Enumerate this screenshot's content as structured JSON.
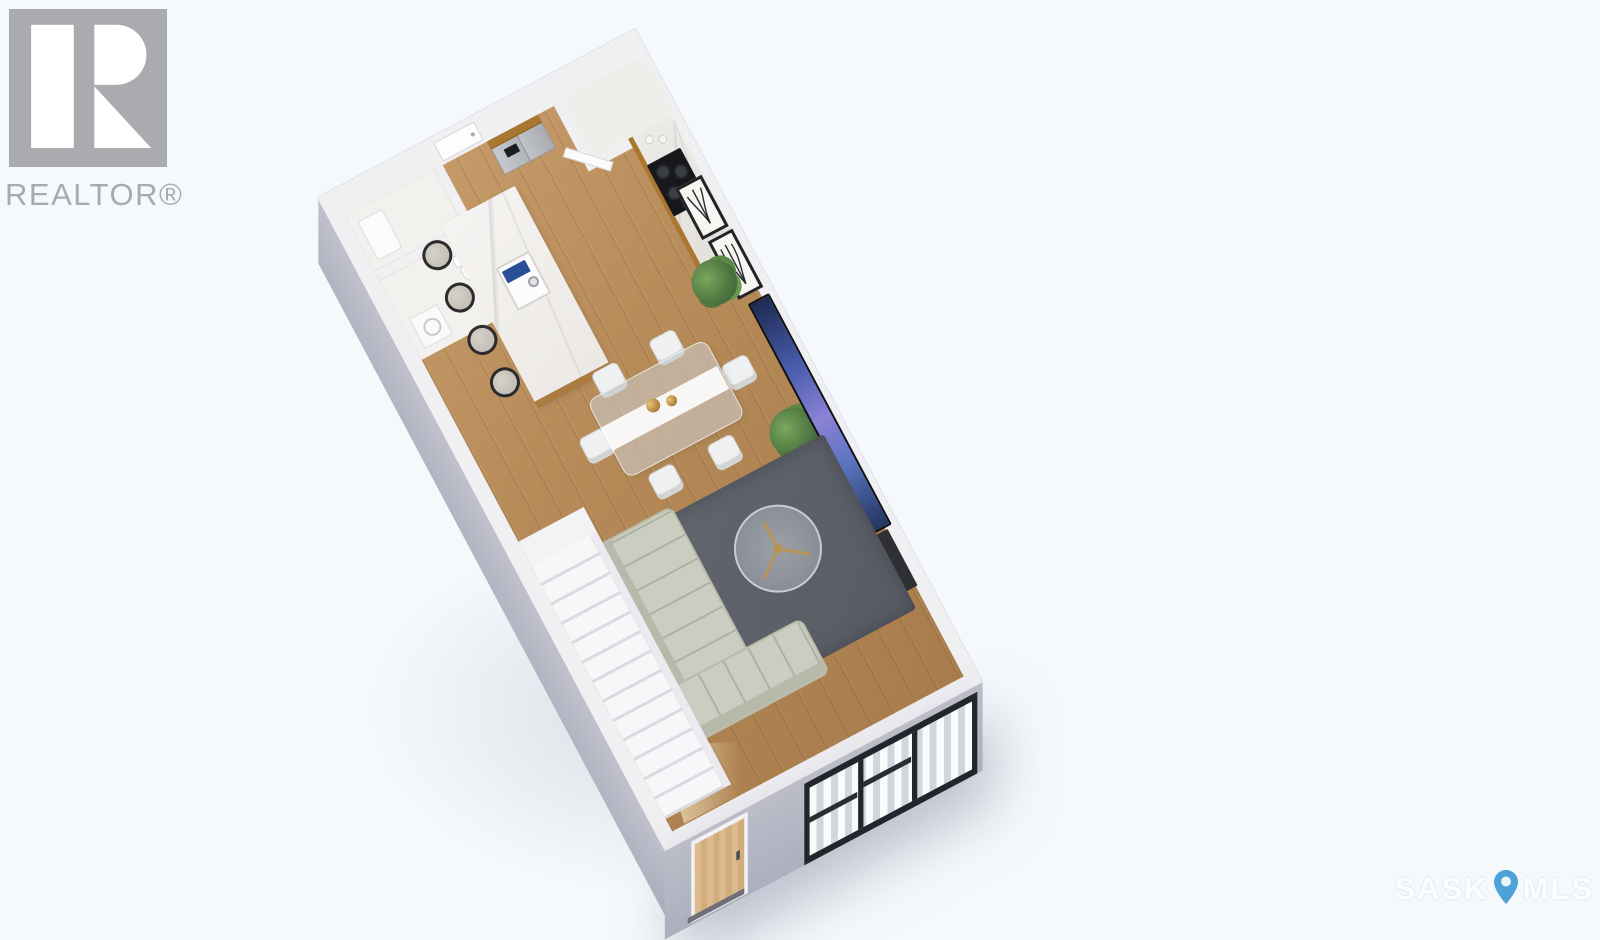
{
  "branding": {
    "realtor_label": "REALTOR®",
    "logo_color": "#a9abae",
    "logo_icon": "realtor-block-r-logo"
  },
  "watermark": {
    "sask": "SASK",
    "mls": "MLS",
    "pin_icon": "map-pin-icon",
    "pin_color": "#4da3d8",
    "text_color": "#ffffff"
  },
  "palette": {
    "page_background": "#f6f9fc",
    "interior_walls": "#f0eff2",
    "exterior_walls": "#b6b7c4",
    "wood_floor": "#b98c5c",
    "marble_counters": "#f3f1ee",
    "cabinet_wood": "#a9772f",
    "area_rug": "#5e6168",
    "sofa": "#cacdbf",
    "cooktop": "#17181b",
    "island_sink_accent": "#2b4f97",
    "tv_screen": "#4a5dae",
    "plants": "#5c8a46",
    "window_frames": "#22252a",
    "front_door_wood": "#d8b483",
    "stairs": "#f4f3f6"
  },
  "floorplan": {
    "view": "isometric 3D render, single level, rotated",
    "features": [
      {
        "name": "entry-door",
        "count": 1
      },
      {
        "name": "closet-laundry-room",
        "count": 1
      },
      {
        "name": "bathroom",
        "count": 1
      },
      {
        "name": "toilet",
        "count": 1
      },
      {
        "name": "vanity-sink",
        "count": 1
      },
      {
        "name": "corner-pantry",
        "count": 1
      },
      {
        "name": "refrigerator",
        "count": 1
      },
      {
        "name": "upper-wood-cabinets",
        "count": 1
      },
      {
        "name": "gas-cooktop",
        "count": 1
      },
      {
        "name": "marble-counter",
        "count": 1
      },
      {
        "name": "kitchen-island-with-sink",
        "count": 1
      },
      {
        "name": "bar-stool",
        "count": 4
      },
      {
        "name": "glass-dining-table",
        "count": 1
      },
      {
        "name": "dining-chair",
        "count": 6
      },
      {
        "name": "gold-vase",
        "count": 2
      },
      {
        "name": "framed-botanical-print",
        "count": 2
      },
      {
        "name": "potted-plant",
        "count": 2
      },
      {
        "name": "wall-mounted-tv",
        "count": 1
      },
      {
        "name": "media-console",
        "count": 1
      },
      {
        "name": "area-rug",
        "count": 1
      },
      {
        "name": "round-coffee-table",
        "count": 1
      },
      {
        "name": "sectional-sofa",
        "count": 1
      },
      {
        "name": "staircase",
        "count": 1
      },
      {
        "name": "front-door",
        "count": 1
      },
      {
        "name": "front-windows",
        "count": 3
      }
    ]
  }
}
